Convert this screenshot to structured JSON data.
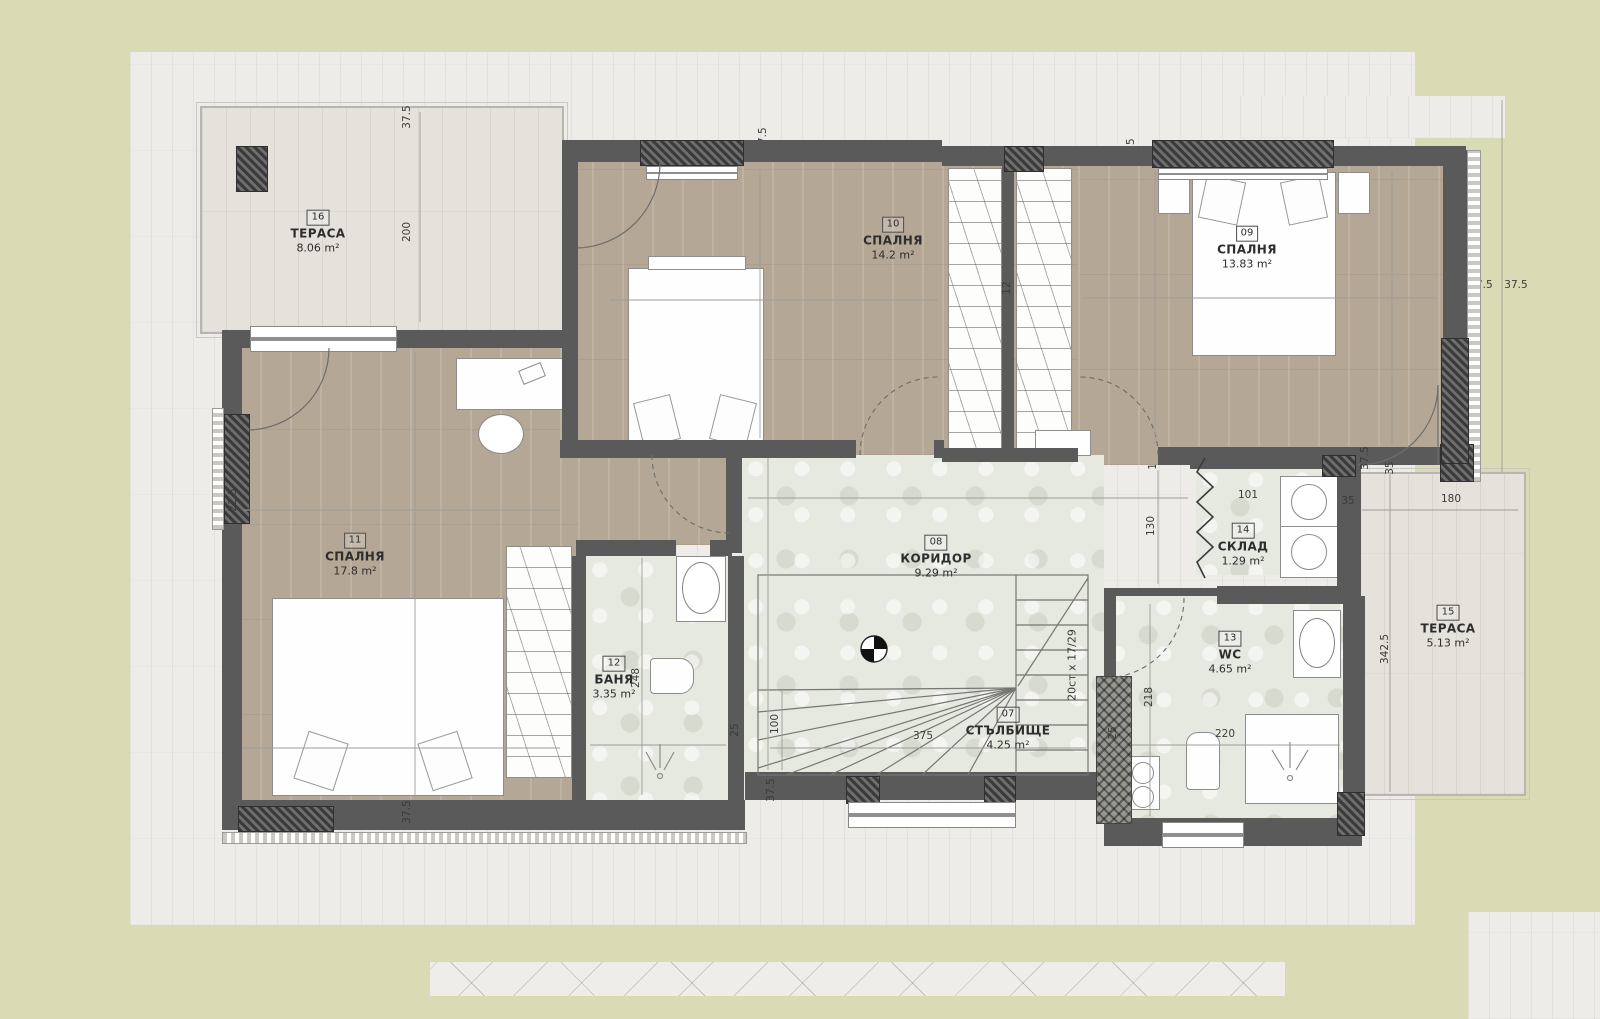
{
  "plan_title": "Second floor plan",
  "rooms": {
    "stairs07": {
      "number": "07",
      "name": "СТЪЛБИЩЕ",
      "area": "4.25 m²"
    },
    "corridor08": {
      "number": "08",
      "name": "КОРИДОР",
      "area": "9.29 m²"
    },
    "bedroom09": {
      "number": "09",
      "name": "СПАЛНЯ",
      "area": "13.83 m²"
    },
    "bedroom10": {
      "number": "10",
      "name": "СПАЛНЯ",
      "area": "14.2 m²"
    },
    "bedroom11": {
      "number": "11",
      "name": "СПАЛНЯ",
      "area": "17.8 m²"
    },
    "bath12": {
      "number": "12",
      "name": "БАНЯ",
      "area": "3.35 m²"
    },
    "wc13": {
      "number": "13",
      "name": "WC",
      "area": "4.65 m²"
    },
    "storage14": {
      "number": "14",
      "name": "СКЛАД",
      "area": "1.29 m²"
    },
    "terrace15": {
      "number": "15",
      "name": "ТЕРАСА",
      "area": "5.13 m²"
    },
    "terrace16": {
      "number": "16",
      "name": "ТЕРАСА",
      "area": "8.06 m²"
    }
  },
  "annotations": {
    "level_marker": "+3.40",
    "stairs_spec": "20ст x 17/29"
  },
  "dims": [
    "37.5",
    "200",
    "37.5",
    "461.5",
    "303",
    "12",
    "37.5",
    "461.5",
    "303",
    "302.5",
    "37.5",
    "37.5",
    "513",
    "475",
    "22.5",
    "338",
    "37.5",
    "12",
    "100",
    "248",
    "150",
    "25",
    "507",
    "12",
    "230",
    "12",
    "130",
    "101",
    "35",
    "375",
    "100",
    "37.5",
    "25",
    "218",
    "220",
    "180",
    "342.5",
    "35",
    "37.5"
  ],
  "colors": {
    "grass": "#d8dbb4",
    "paving": "#edece8",
    "wood_floor": "#b5a795",
    "pale_floor": "#e6e9e0",
    "wall": "#5a5a5a",
    "terrace_plank": "#e4e2da"
  }
}
